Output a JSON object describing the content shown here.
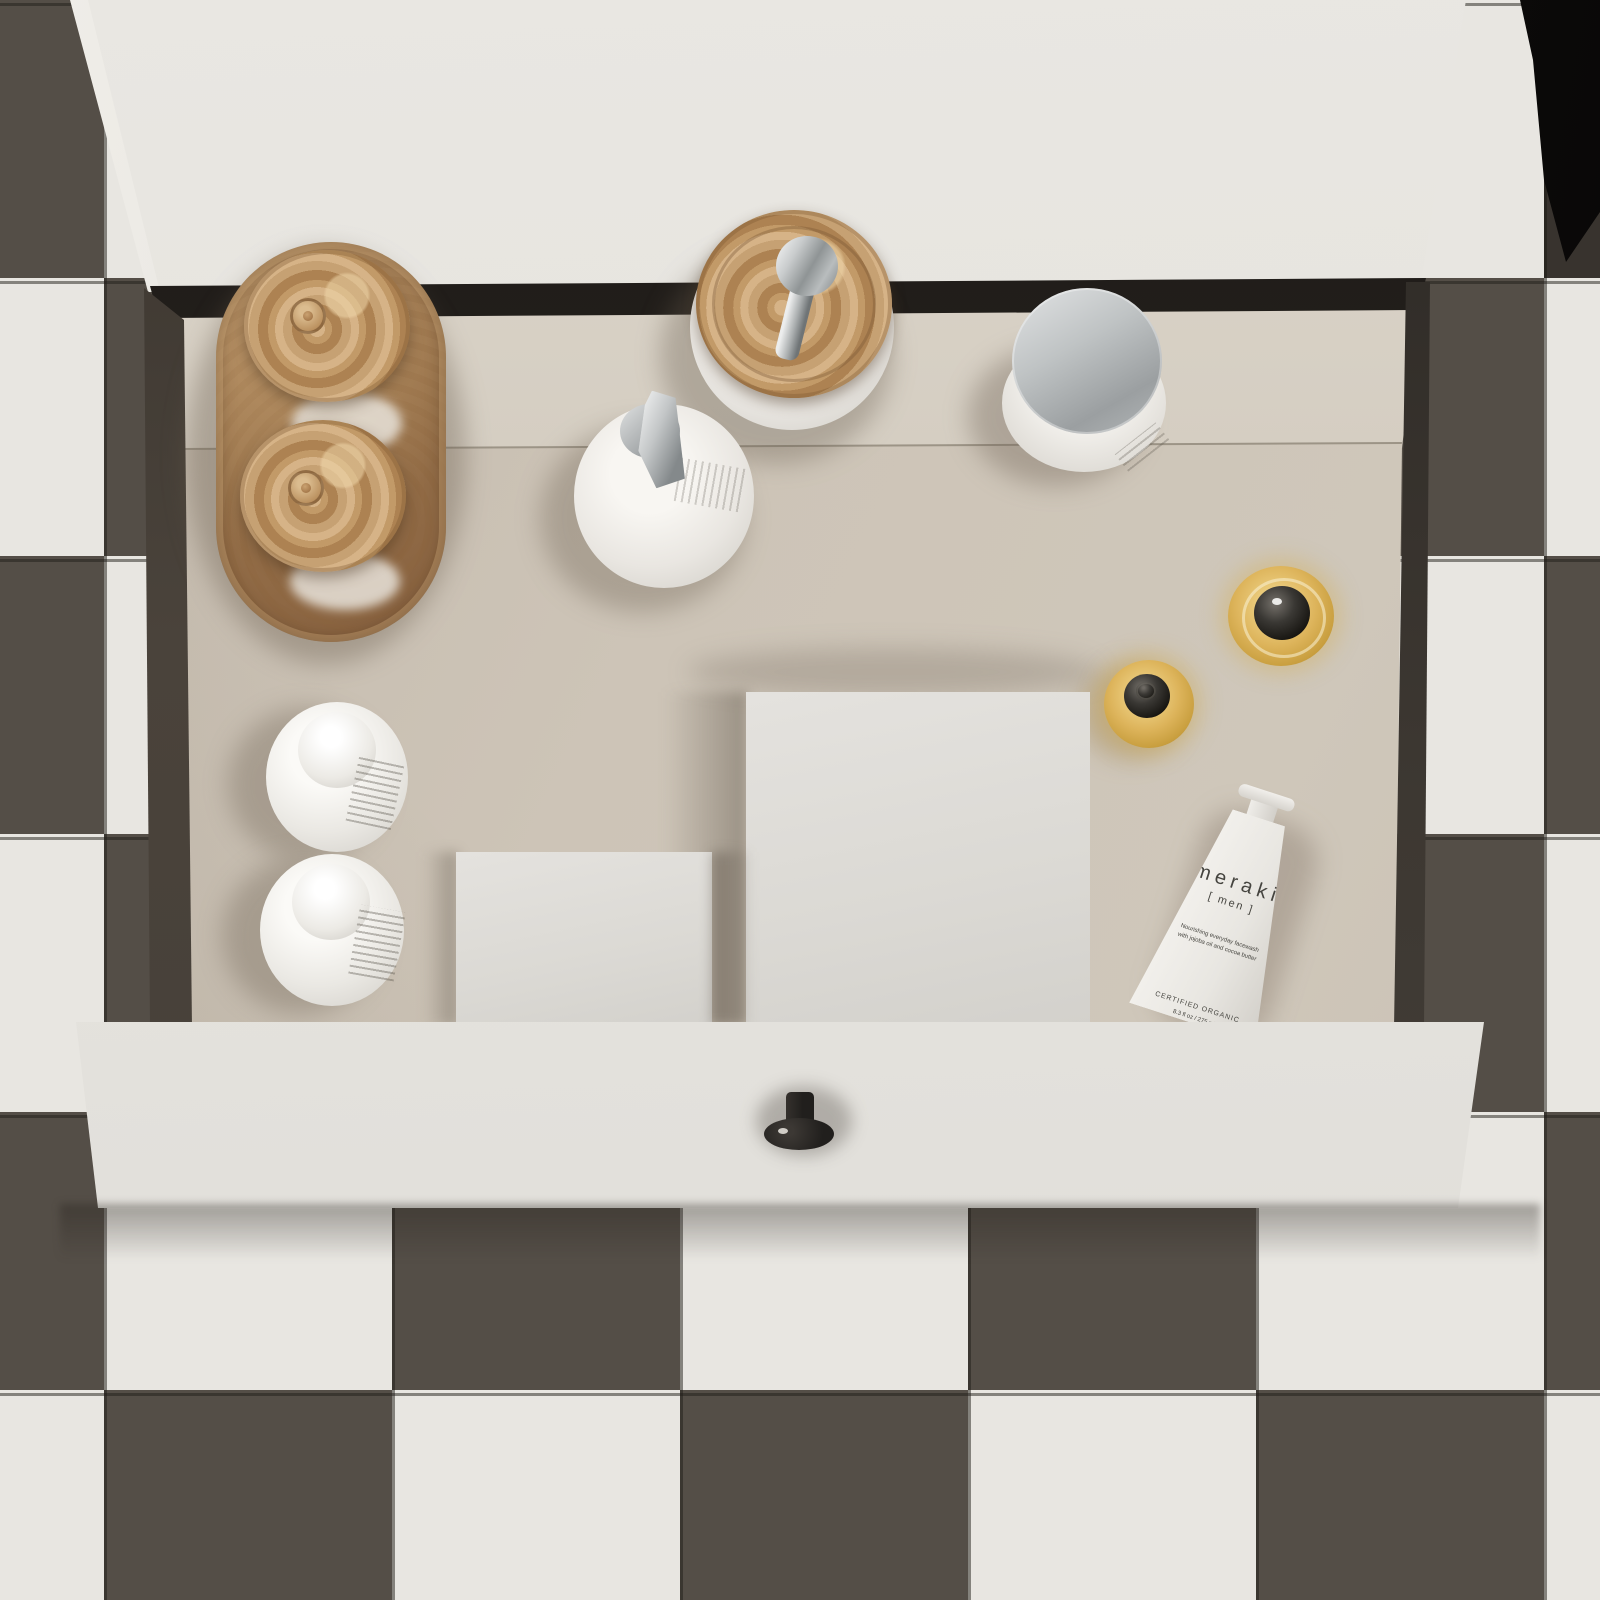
{
  "scene": {
    "description": "Top-down view of an open white bathroom vanity drawer filled with cosmetics, standing on a checkerboard tiled floor",
    "floor": {
      "tile_light": "#e8e6e1",
      "tile_dark": "#544e47"
    },
    "vanity": {
      "cabinet_color": "#e6e4df",
      "drawer_interior_color": "#c9c0b3",
      "drawer_front_color": "#eae8e3",
      "knob_color": "#26231f"
    },
    "items": [
      "burl-wood oval tray",
      "two glass jars with burl-wood lids",
      "soap dispenser with burl-wood lid and chrome pump",
      "white pump bottle with chrome nozzle",
      "cream jar with chrome lid",
      "large amber glass bottle with black ball cap",
      "small amber dropper bottle with black cap",
      "meraki men tube",
      "two white bottles with dome caps",
      "small white box",
      "large white box"
    ]
  },
  "products": {
    "meraki": {
      "brand": "meraki",
      "line": "[ men ]",
      "desc_line1": "Nourishing everyday facewash",
      "desc_line2": "with jojoba oil and cocoa butter",
      "cert": "CERTIFIED ORGANIC",
      "volume": "8.3 fl oz / 275 ml"
    }
  }
}
